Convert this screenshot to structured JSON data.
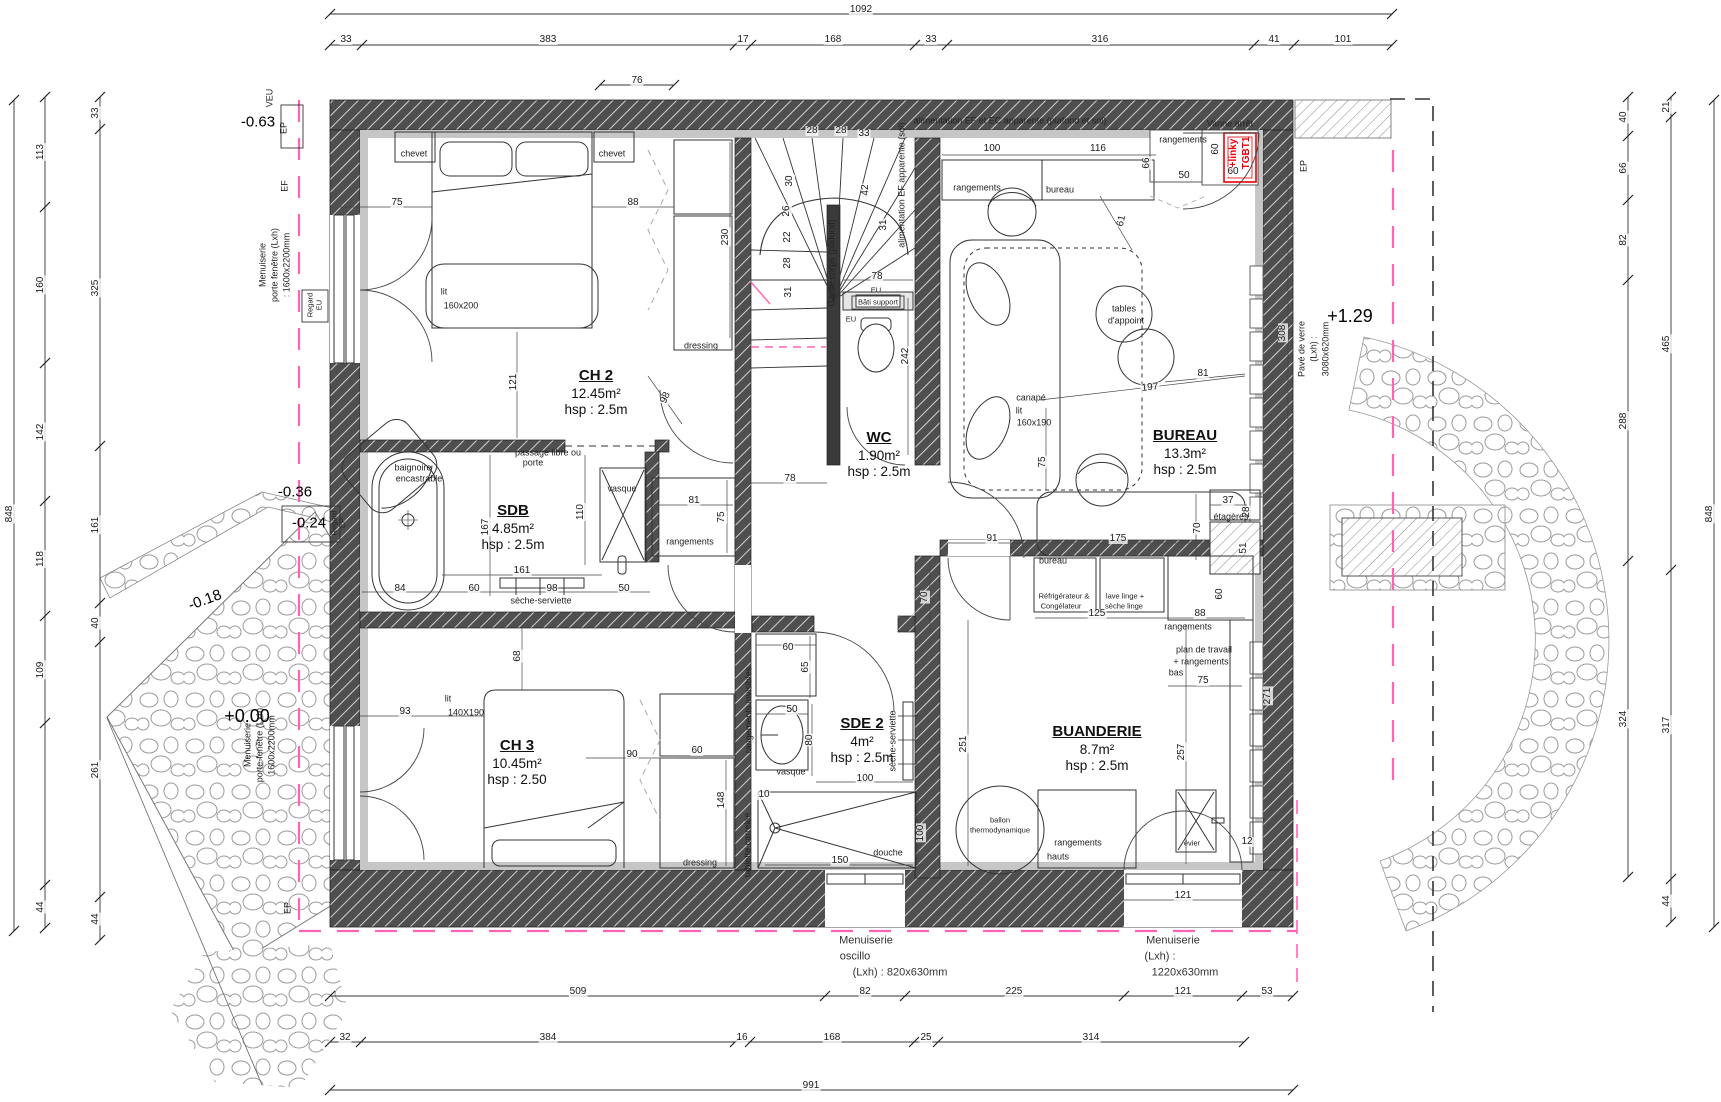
{
  "plan": {
    "type": "architectural-floor-plan",
    "colors": {
      "wall": "#4f4f4f",
      "finish": "#c6c6c6",
      "line": "#333333",
      "pink": "#ff64b4",
      "red": "#e8000a",
      "stone": "#9a9a9a"
    }
  },
  "rooms": [
    {
      "id": "ch2",
      "name": "CH 2",
      "area": "12.45m²",
      "hsp": "hsp : 2.5m",
      "x": 596,
      "y": 392
    },
    {
      "id": "sdb",
      "name": "SDB",
      "area": "4.85m²",
      "hsp": "hsp : 2.5m",
      "x": 513,
      "y": 527
    },
    {
      "id": "ch3",
      "name": "CH 3",
      "area": "10.45m²",
      "hsp": "hsp : 2.50",
      "x": 517,
      "y": 762
    },
    {
      "id": "wc",
      "name": "WC",
      "area": "1.90m²",
      "hsp": "hsp : 2.5m",
      "x": 879,
      "y": 454
    },
    {
      "id": "bureau",
      "name": "BUREAU",
      "area": "13.3m²",
      "hsp": "hsp : 2.5m",
      "x": 1185,
      "y": 452
    },
    {
      "id": "sde2",
      "name": "SDE 2",
      "area": "4m²",
      "hsp": "hsp : 2.5m",
      "x": 862,
      "y": 740
    },
    {
      "id": "buanderie",
      "name": "BUANDERIE",
      "area": "8.7m²",
      "hsp": "hsp : 2.5m",
      "x": 1097,
      "y": 748
    }
  ],
  "levels": [
    {
      "t": "-0.63",
      "x": 258,
      "y": 122,
      "r": 0,
      "cls": "lvl"
    },
    {
      "t": "-0.36",
      "x": 295,
      "y": 492,
      "r": 0,
      "cls": "lvl"
    },
    {
      "t": "-0.24",
      "x": 309,
      "y": 523,
      "r": 0,
      "cls": "lvl"
    },
    {
      "t": "-0.18",
      "x": 205,
      "y": 600,
      "r": -20,
      "cls": "lvl"
    },
    {
      "t": "+0.00",
      "x": 247,
      "y": 716,
      "r": 0,
      "cls": "lvlbig"
    },
    {
      "t": "+1.29",
      "x": 1350,
      "y": 316,
      "r": 0,
      "cls": "lvlbig"
    }
  ],
  "dims": [
    {
      "t": "1092",
      "x": 861,
      "y": 10
    },
    {
      "t": "33",
      "x": 346,
      "y": 40
    },
    {
      "t": "383",
      "x": 548,
      "y": 40
    },
    {
      "t": "17",
      "x": 743,
      "y": 40
    },
    {
      "t": "168",
      "x": 833,
      "y": 40
    },
    {
      "t": "33",
      "x": 931,
      "y": 40
    },
    {
      "t": "316",
      "x": 1100,
      "y": 40
    },
    {
      "t": "41",
      "x": 1274,
      "y": 40
    },
    {
      "t": "101",
      "x": 1343,
      "y": 40
    },
    {
      "t": "76",
      "x": 637,
      "y": 81
    },
    {
      "t": "509",
      "x": 578,
      "y": 992
    },
    {
      "t": "82",
      "x": 865,
      "y": 992
    },
    {
      "t": "225",
      "x": 1014,
      "y": 992
    },
    {
      "t": "121",
      "x": 1183,
      "y": 992
    },
    {
      "t": "53",
      "x": 1267,
      "y": 992
    },
    {
      "t": "32",
      "x": 345,
      "y": 1038
    },
    {
      "t": "384",
      "x": 548,
      "y": 1038
    },
    {
      "t": "16",
      "x": 742,
      "y": 1038
    },
    {
      "t": "168",
      "x": 832,
      "y": 1038
    },
    {
      "t": "25",
      "x": 926,
      "y": 1038
    },
    {
      "t": "314",
      "x": 1091,
      "y": 1038
    },
    {
      "t": "991",
      "x": 811,
      "y": 1086
    },
    {
      "t": "848",
      "x": 10,
      "y": 514,
      "r": -90
    },
    {
      "t": "113",
      "x": 41,
      "y": 152,
      "r": -90
    },
    {
      "t": "160",
      "x": 41,
      "y": 285,
      "r": -90
    },
    {
      "t": "142",
      "x": 41,
      "y": 432,
      "r": -90
    },
    {
      "t": "118",
      "x": 41,
      "y": 559,
      "r": -90
    },
    {
      "t": "109",
      "x": 41,
      "y": 670,
      "r": -90
    },
    {
      "t": "44",
      "x": 41,
      "y": 907,
      "r": -90
    },
    {
      "t": "33",
      "x": 96,
      "y": 113,
      "r": -90
    },
    {
      "t": "325",
      "x": 96,
      "y": 288,
      "r": -90
    },
    {
      "t": "161",
      "x": 96,
      "y": 525,
      "r": -90
    },
    {
      "t": "40",
      "x": 96,
      "y": 623,
      "r": -90
    },
    {
      "t": "261",
      "x": 96,
      "y": 770,
      "r": -90
    },
    {
      "t": "44",
      "x": 96,
      "y": 919,
      "r": -90
    },
    {
      "t": "40",
      "x": 1624,
      "y": 117,
      "r": -90
    },
    {
      "t": "66",
      "x": 1624,
      "y": 168,
      "r": -90
    },
    {
      "t": "82",
      "x": 1624,
      "y": 240,
      "r": -90
    },
    {
      "t": "288",
      "x": 1624,
      "y": 421,
      "r": -90
    },
    {
      "t": "324",
      "x": 1624,
      "y": 719,
      "r": -90
    },
    {
      "t": "21",
      "x": 1667,
      "y": 107,
      "r": -90
    },
    {
      "t": "465",
      "x": 1667,
      "y": 344,
      "r": -90
    },
    {
      "t": "317",
      "x": 1667,
      "y": 725,
      "r": -90
    },
    {
      "t": "44",
      "x": 1667,
      "y": 901,
      "r": -90
    },
    {
      "t": "848",
      "x": 1710,
      "y": 514,
      "r": -90
    },
    {
      "t": "75",
      "x": 397,
      "y": 203
    },
    {
      "t": "88",
      "x": 633,
      "y": 203
    },
    {
      "t": "121",
      "x": 514,
      "y": 382,
      "r": -90
    },
    {
      "t": "230",
      "x": 726,
      "y": 237,
      "r": -90
    },
    {
      "t": "98",
      "x": 666,
      "y": 398,
      "r": -65
    },
    {
      "t": "28",
      "x": 812,
      "y": 131
    },
    {
      "t": "28",
      "x": 841,
      "y": 131
    },
    {
      "t": "33",
      "x": 864,
      "y": 134
    },
    {
      "t": "30",
      "x": 790,
      "y": 181,
      "r": -90
    },
    {
      "t": "26",
      "x": 787,
      "y": 211,
      "r": -90
    },
    {
      "t": "22",
      "x": 788,
      "y": 237,
      "r": -90
    },
    {
      "t": "28",
      "x": 788,
      "y": 263,
      "r": -90
    },
    {
      "t": "31",
      "x": 789,
      "y": 292,
      "r": -90
    },
    {
      "t": "42",
      "x": 866,
      "y": 190,
      "r": -90
    },
    {
      "t": "31",
      "x": 884,
      "y": 225,
      "r": -90
    },
    {
      "t": "78",
      "x": 877,
      "y": 277
    },
    {
      "t": "242",
      "x": 906,
      "y": 356,
      "r": -90
    },
    {
      "t": "78",
      "x": 790,
      "y": 479
    },
    {
      "t": "81",
      "x": 694,
      "y": 501
    },
    {
      "t": "75",
      "x": 722,
      "y": 517,
      "r": -90
    },
    {
      "t": "167",
      "x": 486,
      "y": 527,
      "r": -90
    },
    {
      "t": "110",
      "x": 581,
      "y": 512,
      "r": -90
    },
    {
      "t": "161",
      "x": 522,
      "y": 571
    },
    {
      "t": "84",
      "x": 400,
      "y": 589
    },
    {
      "t": "60",
      "x": 474,
      "y": 589
    },
    {
      "t": "98",
      "x": 552,
      "y": 589
    },
    {
      "t": "50",
      "x": 624,
      "y": 589
    },
    {
      "t": "68",
      "x": 518,
      "y": 656,
      "r": -90
    },
    {
      "t": "93",
      "x": 405,
      "y": 712
    },
    {
      "t": "90",
      "x": 632,
      "y": 755
    },
    {
      "t": "60",
      "x": 697,
      "y": 751
    },
    {
      "t": "148",
      "x": 722,
      "y": 800,
      "r": -90
    },
    {
      "t": "60",
      "x": 788,
      "y": 648
    },
    {
      "t": "65",
      "x": 806,
      "y": 667,
      "r": -90
    },
    {
      "t": "50",
      "x": 792,
      "y": 710
    },
    {
      "t": "80",
      "x": 810,
      "y": 740,
      "r": -90
    },
    {
      "t": "100",
      "x": 865,
      "y": 779
    },
    {
      "t": "70",
      "x": 925,
      "y": 597,
      "r": -90
    },
    {
      "t": "10",
      "x": 764,
      "y": 795
    },
    {
      "t": "150",
      "x": 840,
      "y": 861
    },
    {
      "t": "100",
      "x": 921,
      "y": 833,
      "r": -90
    },
    {
      "t": "251",
      "x": 964,
      "y": 744,
      "r": -90
    },
    {
      "t": "125",
      "x": 1097,
      "y": 614
    },
    {
      "t": "88",
      "x": 1200,
      "y": 614
    },
    {
      "t": "60",
      "x": 1220,
      "y": 594,
      "r": -90
    },
    {
      "t": "75",
      "x": 1203,
      "y": 681
    },
    {
      "t": "257",
      "x": 1182,
      "y": 752,
      "r": -90
    },
    {
      "t": "271",
      "x": 1268,
      "y": 696,
      "r": -90
    },
    {
      "t": "12",
      "x": 1247,
      "y": 842
    },
    {
      "t": "121",
      "x": 1183,
      "y": 896
    },
    {
      "t": "100",
      "x": 992,
      "y": 149
    },
    {
      "t": "116",
      "x": 1098,
      "y": 149
    },
    {
      "t": "66",
      "x": 1147,
      "y": 163,
      "r": -90
    },
    {
      "t": "50",
      "x": 1184,
      "y": 176
    },
    {
      "t": "60",
      "x": 1233,
      "y": 172
    },
    {
      "t": "60",
      "x": 1216,
      "y": 149,
      "r": -90
    },
    {
      "t": "61",
      "x": 1122,
      "y": 221,
      "r": -78
    },
    {
      "t": "197",
      "x": 1150,
      "y": 388,
      "r": -6
    },
    {
      "t": "81",
      "x": 1203,
      "y": 374
    },
    {
      "t": "308",
      "x": 1283,
      "y": 333,
      "r": -90
    },
    {
      "t": "91",
      "x": 992,
      "y": 539
    },
    {
      "t": "175",
      "x": 1118,
      "y": 539
    },
    {
      "t": "70",
      "x": 1198,
      "y": 528,
      "r": -90
    },
    {
      "t": "37",
      "x": 1228,
      "y": 501
    },
    {
      "t": "28",
      "x": 1247,
      "y": 512,
      "r": -90
    },
    {
      "t": "51",
      "x": 1244,
      "y": 548,
      "r": -90
    },
    {
      "t": "75",
      "x": 1043,
      "y": 462,
      "r": -90
    }
  ],
  "labels": [
    {
      "t": "chevet",
      "x": 414,
      "y": 154
    },
    {
      "t": "chevet",
      "x": 612,
      "y": 154
    },
    {
      "t": "lit",
      "x": 444,
      "y": 292
    },
    {
      "t": "160x200",
      "x": 461,
      "y": 306
    },
    {
      "t": "dressing",
      "x": 701,
      "y": 346
    },
    {
      "t": "passage libre ou",
      "x": 548,
      "y": 453
    },
    {
      "t": "porte",
      "x": 533,
      "y": 463
    },
    {
      "t": "baignoire",
      "x": 413,
      "y": 468
    },
    {
      "t": "encastrable",
      "x": 419,
      "y": 479
    },
    {
      "t": "vasque",
      "x": 622,
      "y": 489
    },
    {
      "t": "sèche-serviette",
      "x": 541,
      "y": 601
    },
    {
      "t": "rangements",
      "x": 690,
      "y": 542
    },
    {
      "t": "Garde corps (plafond)",
      "x": 832,
      "y": 263,
      "r": -90
    },
    {
      "t": "alimentation EF apparente (sol)",
      "x": 902,
      "y": 185,
      "r": -90
    },
    {
      "t": "alimentation EF et EC apparente (plafond et sol)",
      "x": 1010,
      "y": 121
    },
    {
      "t": "EU",
      "x": 876,
      "y": 290,
      "cls": "tiny"
    },
    {
      "t": "Bâti support",
      "x": 878,
      "y": 302,
      "cls": "tiny"
    },
    {
      "t": "EU",
      "x": 851,
      "y": 319,
      "cls": "tiny"
    },
    {
      "t": "rangements",
      "x": 977,
      "y": 188
    },
    {
      "t": "bureau",
      "x": 1060,
      "y": 190
    },
    {
      "t": "Vanne arrêt",
      "x": 1230,
      "y": 124
    },
    {
      "t": "TGBT1",
      "x": 1247,
      "y": 153,
      "r": -90,
      "cls": "red"
    },
    {
      "t": "+linky",
      "x": 1234,
      "y": 153,
      "r": -90,
      "cls": "red"
    },
    {
      "t": "canapé",
      "x": 1031,
      "y": 398
    },
    {
      "t": "lit",
      "x": 1019,
      "y": 411
    },
    {
      "t": "160x190",
      "x": 1034,
      "y": 423
    },
    {
      "t": "tables",
      "x": 1124,
      "y": 309
    },
    {
      "t": "d'appoint",
      "x": 1126,
      "y": 321
    },
    {
      "t": "étagères",
      "x": 1231,
      "y": 517
    },
    {
      "t": "bureau",
      "x": 1053,
      "y": 561
    },
    {
      "t": "Réfrigérateur &",
      "x": 1064,
      "y": 596,
      "cls": "tiny"
    },
    {
      "t": "Congélateur",
      "x": 1061,
      "y": 606,
      "cls": "tiny"
    },
    {
      "t": "lave linge +",
      "x": 1125,
      "y": 596,
      "cls": "tiny"
    },
    {
      "t": "sèche linge",
      "x": 1124,
      "y": 606,
      "cls": "tiny"
    },
    {
      "t": "rangements",
      "x": 1183,
      "y": 140
    },
    {
      "t": "rangements",
      "x": 1188,
      "y": 627
    },
    {
      "t": "plan de travail",
      "x": 1204,
      "y": 650
    },
    {
      "t": "+ rangements",
      "x": 1201,
      "y": 662
    },
    {
      "t": "bas",
      "x": 1176,
      "y": 673
    },
    {
      "t": "ballon",
      "x": 1000,
      "y": 820,
      "cls": "tiny"
    },
    {
      "t": "thermodynamique",
      "x": 1000,
      "y": 830,
      "cls": "tiny"
    },
    {
      "t": "évier",
      "x": 1192,
      "y": 843,
      "cls": "tiny"
    },
    {
      "t": "rangements",
      "x": 1078,
      "y": 843
    },
    {
      "t": "hauts",
      "x": 1058,
      "y": 857
    },
    {
      "t": "dressing",
      "x": 700,
      "y": 863
    },
    {
      "t": "rangements invisibles",
      "x": 749,
      "y": 710,
      "r": -90
    },
    {
      "t": "tablette carrelée",
      "x": 748,
      "y": 845,
      "r": -90
    },
    {
      "t": "vasque",
      "x": 791,
      "y": 772
    },
    {
      "t": "sèche-serviette",
      "x": 893,
      "y": 741,
      "r": -90
    },
    {
      "t": "douche",
      "x": 888,
      "y": 853
    },
    {
      "t": "lit",
      "x": 448,
      "y": 699
    },
    {
      "t": "140X190",
      "x": 466,
      "y": 713
    },
    {
      "t": "Menuiserie",
      "x": 866,
      "y": 941,
      "cls": "note"
    },
    {
      "t": "oscillo",
      "x": 855,
      "y": 957,
      "cls": "note"
    },
    {
      "t": "(Lxh) : 820x630mm",
      "x": 900,
      "y": 973,
      "cls": "note"
    },
    {
      "t": "Menuiserie",
      "x": 1173,
      "y": 941,
      "cls": "note"
    },
    {
      "t": "(Lxh) :",
      "x": 1160,
      "y": 957,
      "cls": "note"
    },
    {
      "t": "1220x630mm",
      "x": 1185,
      "y": 973,
      "cls": "note"
    },
    {
      "t": "Pavé de verre",
      "x": 1302,
      "y": 349,
      "r": -90
    },
    {
      "t": "(Lxh) :",
      "x": 1314,
      "y": 349,
      "r": -90
    },
    {
      "t": "3080x620mm",
      "x": 1326,
      "y": 349,
      "r": -90
    },
    {
      "t": "EP",
      "x": 1304,
      "y": 166,
      "r": -90
    },
    {
      "t": "VEU",
      "x": 270,
      "y": 98,
      "r": -90
    },
    {
      "t": "EP",
      "x": 284,
      "y": 128,
      "r": -90
    },
    {
      "t": "EF",
      "x": 285,
      "y": 186,
      "r": -90
    },
    {
      "t": "Menuiserie",
      "x": 263,
      "y": 265,
      "r": -90
    },
    {
      "t": "porte fenêtre (Lxh)",
      "x": 275,
      "y": 265,
      "r": -90
    },
    {
      "t": ": 1600x2200mm",
      "x": 287,
      "y": 265,
      "r": -90
    },
    {
      "t": "Regard",
      "x": 310,
      "y": 305,
      "r": -90,
      "cls": "tiny"
    },
    {
      "t": "EU",
      "x": 319,
      "y": 305,
      "r": -90,
      "cls": "tiny"
    },
    {
      "t": "Regard",
      "x": 334,
      "y": 523,
      "r": -90,
      "cls": "tiny"
    },
    {
      "t": "EP",
      "x": 342,
      "y": 523,
      "r": -90,
      "cls": "tiny"
    },
    {
      "t": "Menuiserie",
      "x": 248,
      "y": 745,
      "r": -90
    },
    {
      "t": "porte-fenêtre (Lxh)",
      "x": 260,
      "y": 745,
      "r": -90
    },
    {
      "t": "1600x2200mm",
      "x": 272,
      "y": 745,
      "r": -90
    },
    {
      "t": "EP",
      "x": 288,
      "y": 908,
      "r": -90
    }
  ]
}
